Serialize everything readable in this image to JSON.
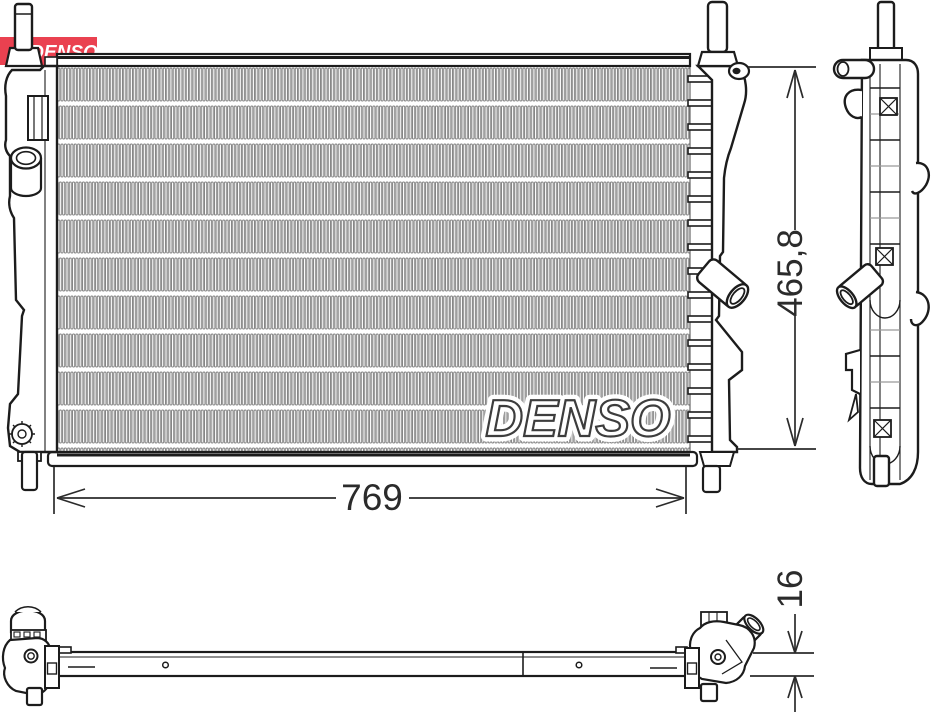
{
  "brand": {
    "logo_text": "DENSO",
    "watermark_text": "DENSO",
    "logo_bg_color": "#ea4150",
    "logo_text_color": "#ffffff"
  },
  "diagram": {
    "type": "technical-drawing",
    "subject": "radiator",
    "dimensions": [
      {
        "id": "width",
        "value": "769",
        "orientation": "horizontal"
      },
      {
        "id": "height",
        "value": "465,8",
        "orientation": "vertical"
      },
      {
        "id": "thickness",
        "value": "16",
        "orientation": "vertical"
      }
    ],
    "colors": {
      "line": "#1c1c1c",
      "fin": "#7a7a7a",
      "dimension": "#2b2b2b",
      "logo_red": "#ea4150"
    }
  }
}
